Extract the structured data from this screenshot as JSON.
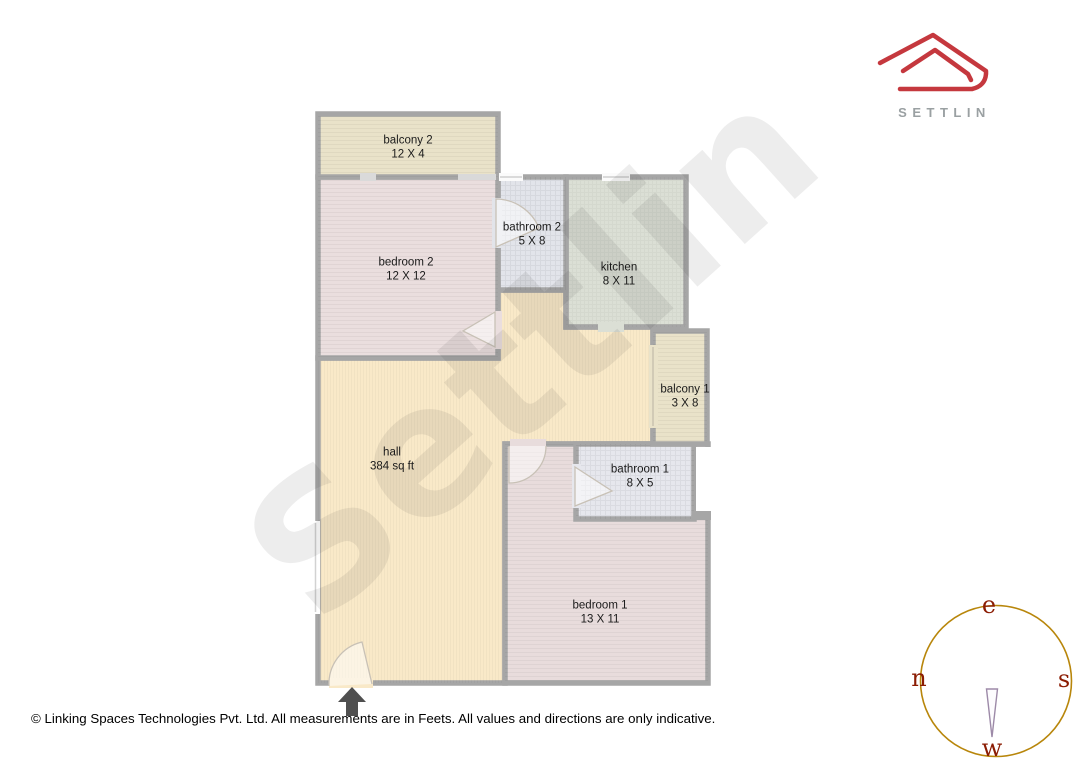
{
  "watermark": {
    "text": "Settlin"
  },
  "logo": {
    "brand": "SETTLIN",
    "roof_color": "#c5383e",
    "brand_color": "#9aa0a2"
  },
  "floorplan": {
    "wall_color": "#a6a6a6",
    "entrance_arrow_color": "#4f4f4f",
    "rooms": [
      {
        "id": "balcony-2",
        "name": "balcony 2",
        "dims": "12 X 4",
        "fill": "#e9e2c9"
      },
      {
        "id": "bedroom-2",
        "name": "bedroom 2",
        "dims": "12 X 12",
        "fill": "#eadede"
      },
      {
        "id": "bathroom-2",
        "name": "bathroom 2",
        "dims": "5 X 8",
        "fill": "#e2e4ea"
      },
      {
        "id": "kitchen",
        "name": "kitchen",
        "dims": "8 X 11",
        "fill": "#dbdfd5"
      },
      {
        "id": "balcony-1",
        "name": "balcony 1",
        "dims": "3 X 8",
        "fill": "#e9e2c9"
      },
      {
        "id": "hall",
        "name": "hall",
        "dims": "384 sq ft",
        "fill": "#f9e9c8"
      },
      {
        "id": "bathroom-1",
        "name": "bathroom 1",
        "dims": "8 X 5",
        "fill": "#e6e7ed"
      },
      {
        "id": "bedroom-1",
        "name": "bedroom 1",
        "dims": "13 X 11",
        "fill": "#e8dcdc"
      }
    ]
  },
  "compass": {
    "top": "e",
    "left": "n",
    "right": "s",
    "bottom": "w",
    "ring_color": "#b8860b",
    "letter_color": "#8b1c03"
  },
  "footer": {
    "text": "© Linking Spaces Technologies Pvt. Ltd. All measurements are in Feets. All values and directions are only indicative."
  }
}
